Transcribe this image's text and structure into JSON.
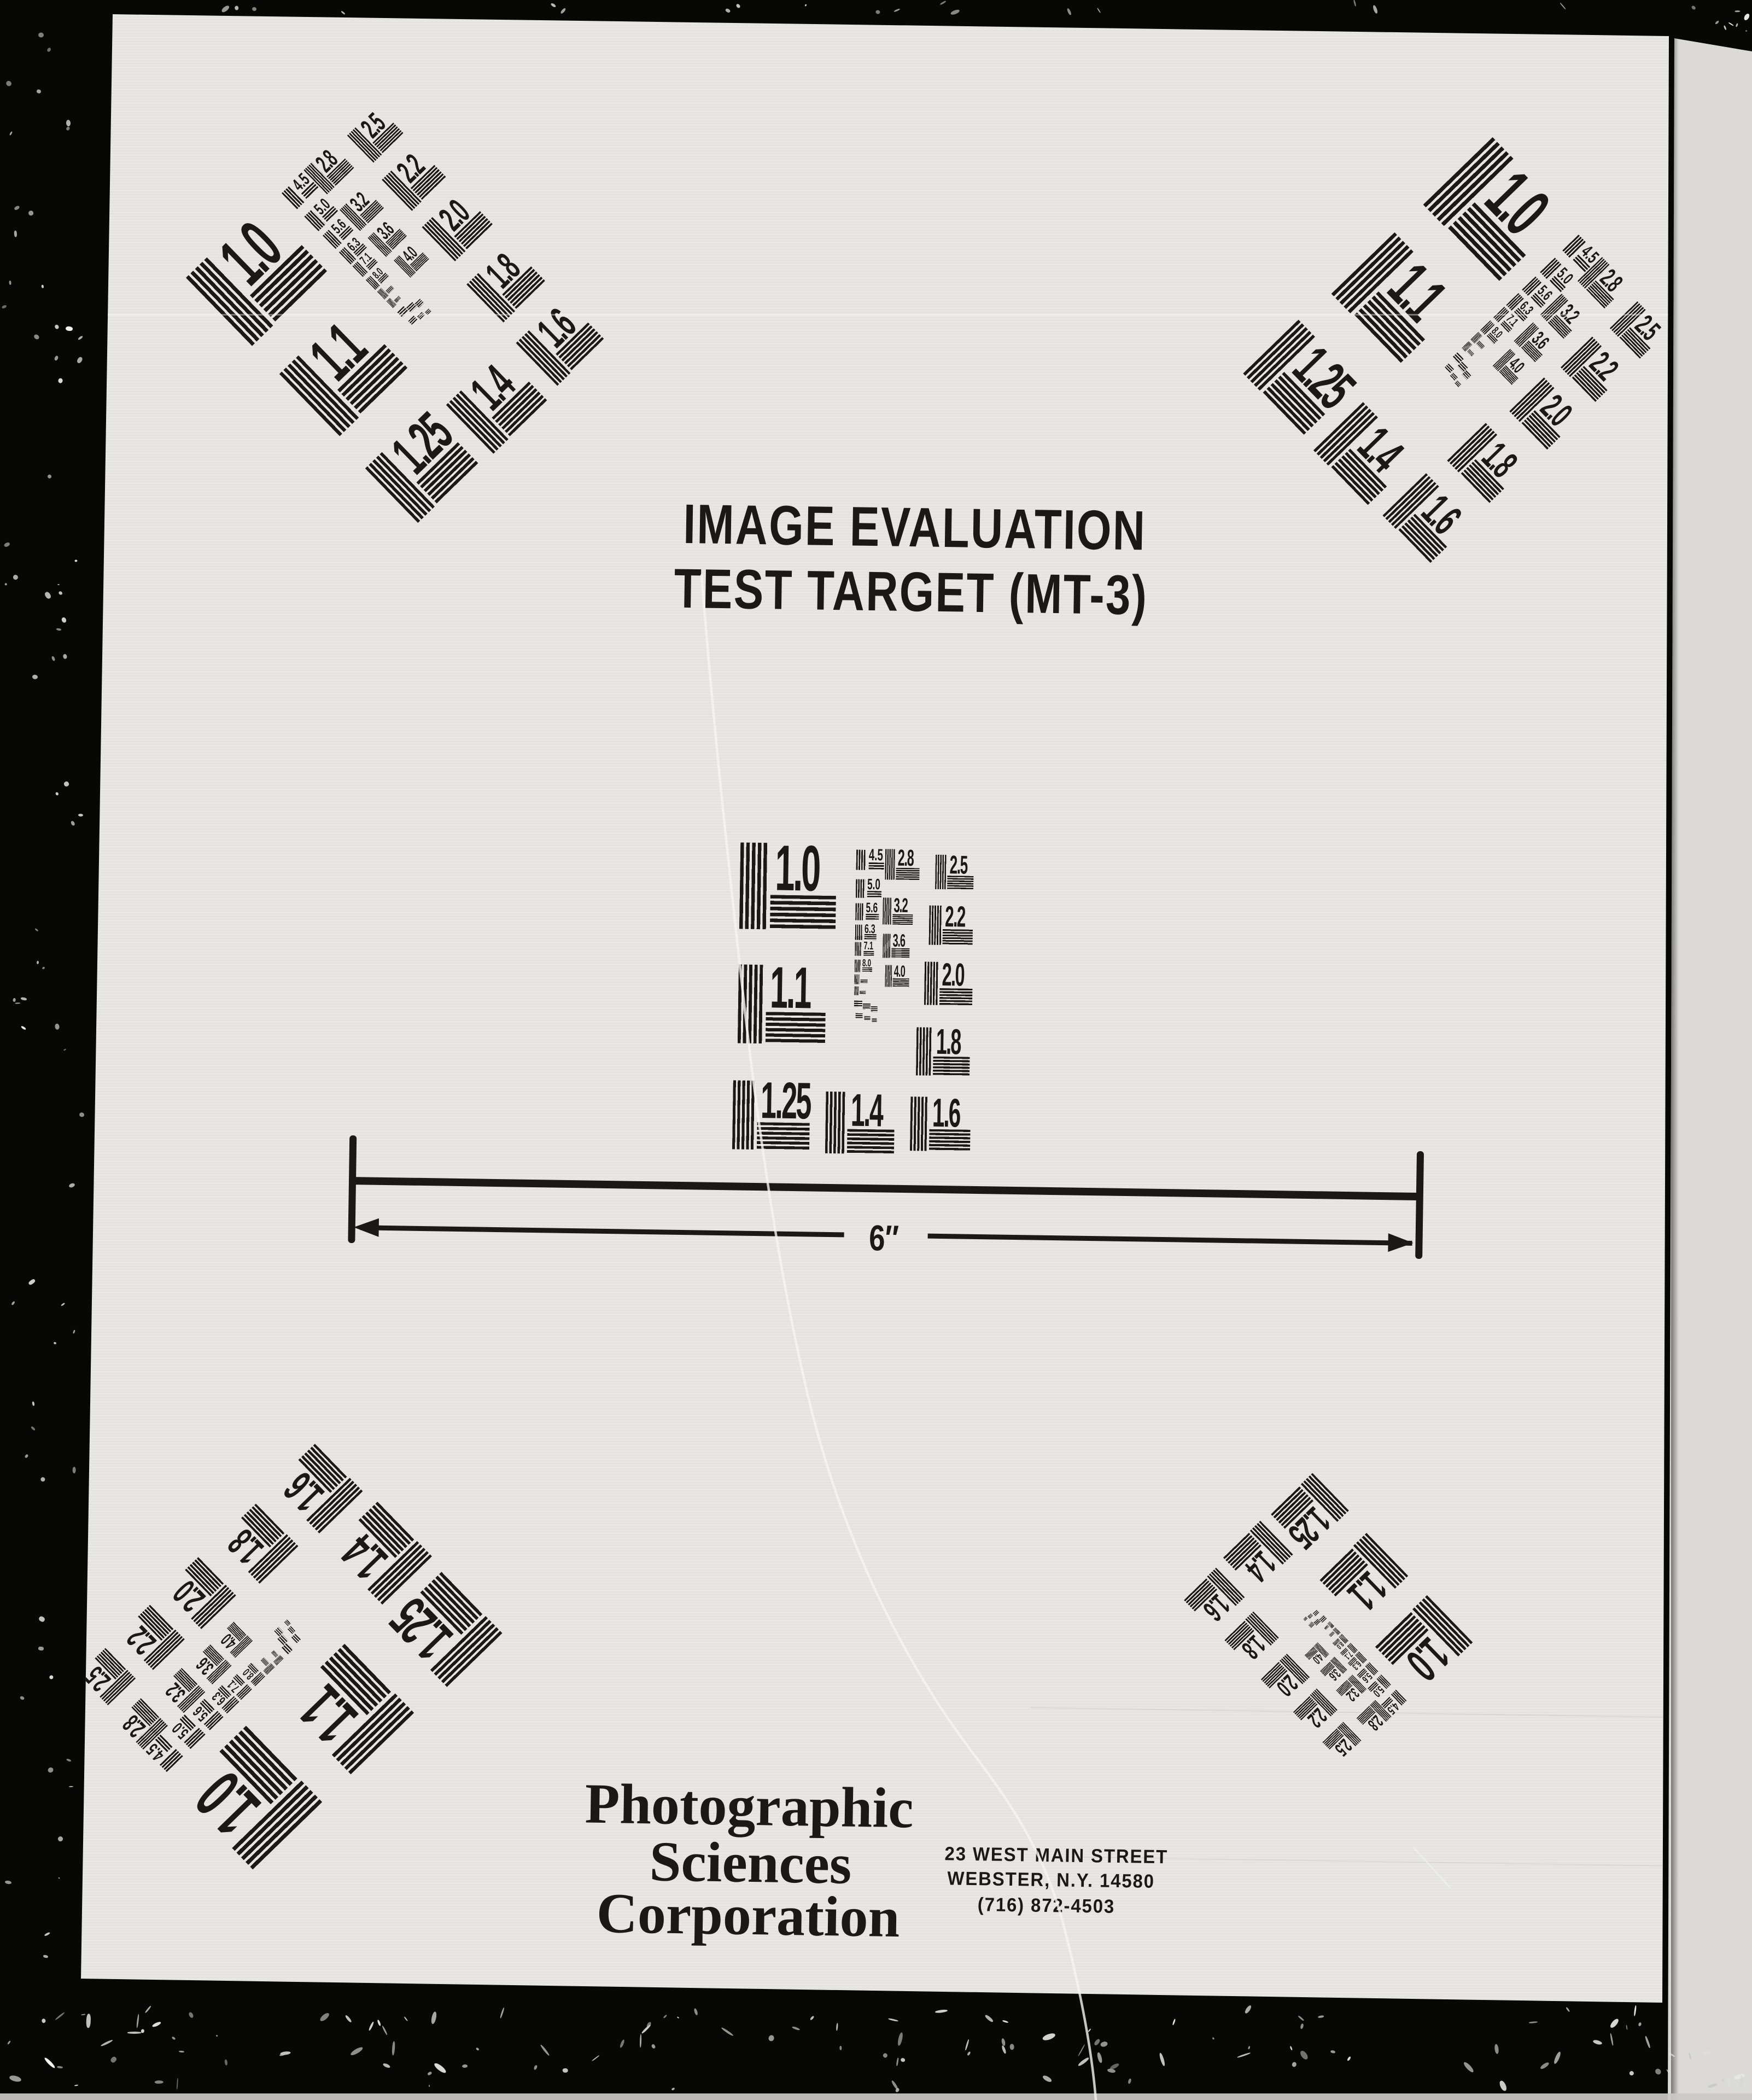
{
  "title": {
    "line1": "IMAGE EVALUATION",
    "line2": "TEST TARGET (MT-3)"
  },
  "pattern": {
    "large_values": [
      "1.0",
      "1.1",
      "1.25",
      "1.4",
      "1.6",
      "1.8",
      "2.0",
      "2.2",
      "2.5",
      "2.8",
      "3.2",
      "3.6",
      "4.0"
    ],
    "small_values": [
      "4.5",
      "5.0",
      "5.6",
      "6.3",
      "7.1",
      "8.0"
    ]
  },
  "ruler": {
    "label": "6″"
  },
  "footer": {
    "company_lines": [
      "Photographic",
      "Sciences",
      "Corporation"
    ],
    "address_lines": [
      "23 WEST MAIN STREET",
      "WEBSTER, N.Y. 14580",
      "(716) 872-4503"
    ]
  },
  "colors": {
    "ink": "#1b1916",
    "page": "#e8e7e3",
    "film_black": "#070706",
    "right_strip": "#dbdad6",
    "scratch": "#f6f5f1"
  }
}
